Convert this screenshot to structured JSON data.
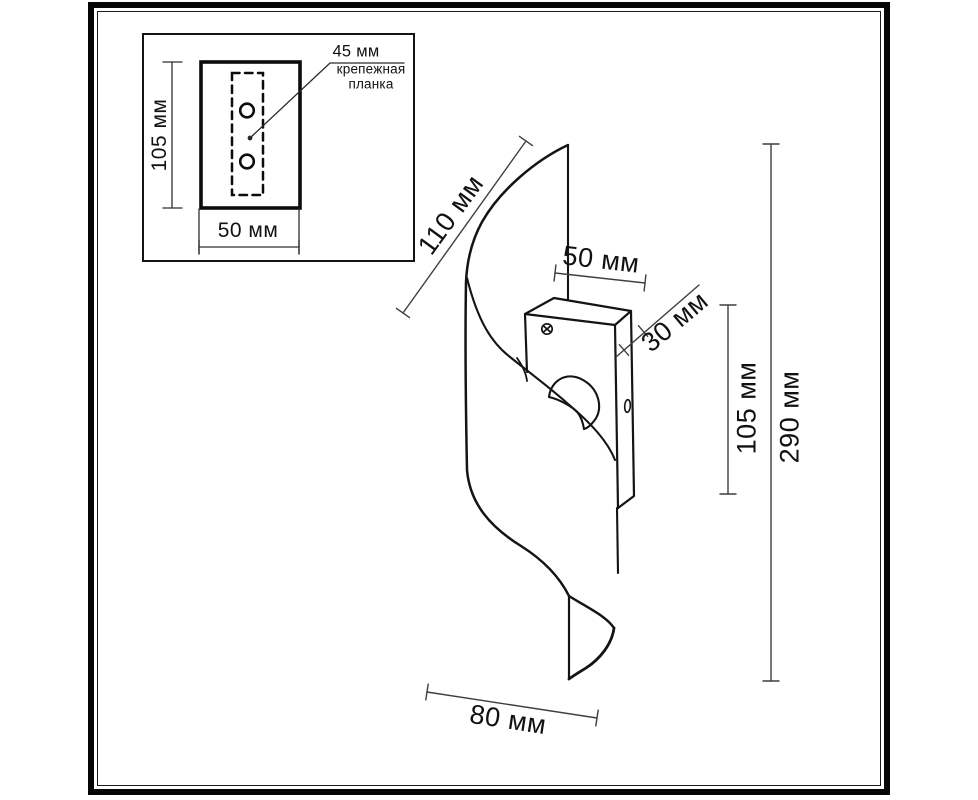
{
  "drawing_type": "wall-lamp dimensional technical drawing",
  "inset": {
    "dim_height": "105 мм",
    "dim_width": "50 мм",
    "callout_value": "45 мм",
    "callout_line1": "крепежная",
    "callout_line2": "планка"
  },
  "dims": {
    "diagonal_110": "110 мм",
    "width_50": "50 мм",
    "depth_30": "30 мм",
    "box_height_105": "105 мм",
    "total_height_290": "290 мм",
    "bottom_80": "80 мм"
  },
  "colors": {
    "background": "#ffffff",
    "line": "#141414",
    "dimension_line": "#3f3f3f",
    "frame": "#060606"
  }
}
